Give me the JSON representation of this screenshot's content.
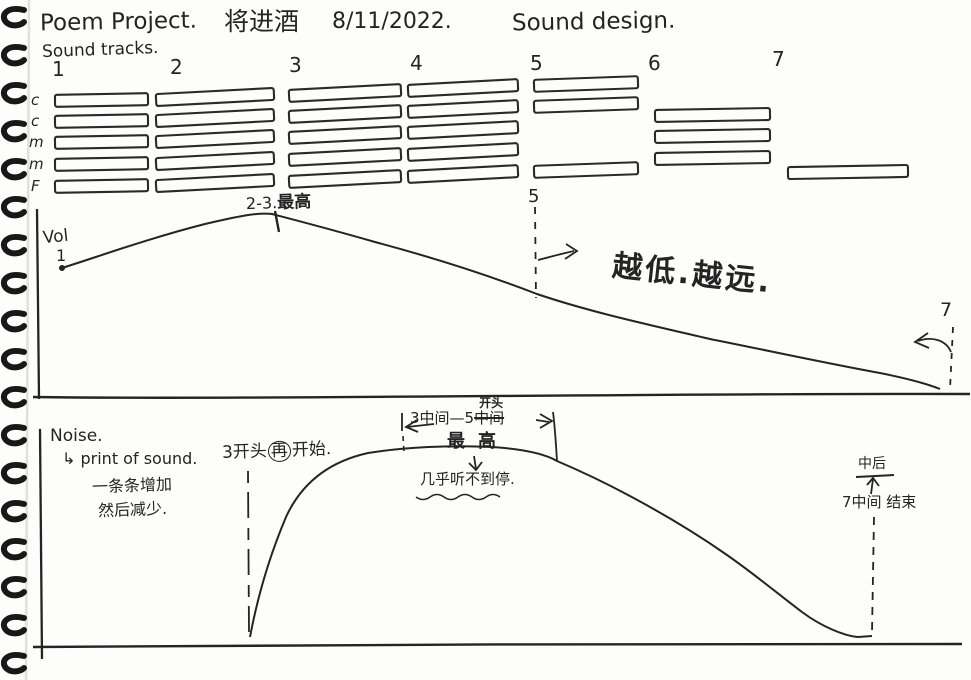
{
  "colors": {
    "ink": "#242424",
    "paper": "#fdfdfb"
  },
  "header": {
    "title_en": "Poem Project.",
    "title_zh": "将进酒",
    "date": "8/11/2022.",
    "subtitle_right": "Sound design.",
    "tracks_label": "Sound tracks."
  },
  "tracks": {
    "column_numbers": [
      "1",
      "2",
      "3",
      "4",
      "5",
      "6",
      "7"
    ],
    "row_labels": [
      "c",
      "c",
      "m",
      "m",
      "F"
    ],
    "filled_cells": [
      {
        "col": 1,
        "row": 1
      },
      {
        "col": 1,
        "row": 2
      },
      {
        "col": 1,
        "row": 3
      },
      {
        "col": 1,
        "row": 4
      },
      {
        "col": 1,
        "row": 5
      },
      {
        "col": 2,
        "row": 1
      },
      {
        "col": 2,
        "row": 2
      },
      {
        "col": 2,
        "row": 3
      },
      {
        "col": 2,
        "row": 4
      },
      {
        "col": 2,
        "row": 5
      },
      {
        "col": 3,
        "row": 1
      },
      {
        "col": 3,
        "row": 2
      },
      {
        "col": 3,
        "row": 3
      },
      {
        "col": 3,
        "row": 4
      },
      {
        "col": 3,
        "row": 5
      },
      {
        "col": 4,
        "row": 1
      },
      {
        "col": 4,
        "row": 2
      },
      {
        "col": 4,
        "row": 3
      },
      {
        "col": 4,
        "row": 4
      },
      {
        "col": 4,
        "row": 5
      },
      {
        "col": 5,
        "row": 1
      },
      {
        "col": 5,
        "row": 2
      },
      {
        "col": 5,
        "row": 5
      },
      {
        "col": 6,
        "row": 2
      },
      {
        "col": 6,
        "row": 3
      },
      {
        "col": 6,
        "row": 4
      },
      {
        "col": 7,
        "row": 5
      }
    ]
  },
  "volume_section": {
    "axis_label": "Vol",
    "start_marker": "1",
    "peak_prefix": "2-3.",
    "peak_zh": "最高",
    "marker_5": "5",
    "fade_note": "越低.越远.",
    "marker_7": "7"
  },
  "noise_section": {
    "axis_label": "Noise.",
    "arrow_glyph": "↳",
    "definition": "print of sound.",
    "note_line1": "一条条增加",
    "note_line2": "然后减少.",
    "restart_pre": "3开头",
    "restart_circled": "再",
    "restart_post": "开始.",
    "span_pre": "3中间—5",
    "span_struck": "中间",
    "span_correction": "开头",
    "peak_label": "最高",
    "quiet_note": "几乎听不到停.",
    "end_note_top": "中后",
    "end_note_bottom": "7中间 结束"
  }
}
